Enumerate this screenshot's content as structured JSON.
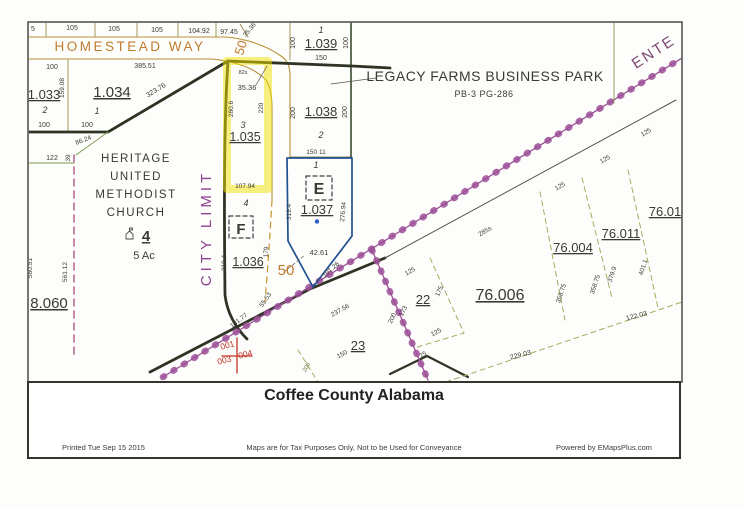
{
  "colors": {
    "ink": "#3a3933",
    "orange": "#c07b2e",
    "citypurple": "#8e3f8f",
    "mauve": "#7c4a74",
    "red": "#c23327",
    "dimgreen": "#6a7a42",
    "road_purple": "#9b4f96",
    "boundary_dark": "#2e3424",
    "highlight_yellow": "#f0e000",
    "parcel_blue": "#20508f",
    "road_tan": "#b98f33"
  },
  "footer": {
    "title": "Coffee County Alabama",
    "printed": "Printed Tue Sep 15 2015",
    "disclaimer": "Maps are for Tax Purposes Only, Not to be Used for Conveyance",
    "powered": "Powered by EMapsPlus.com"
  },
  "map": {
    "labels": [
      {
        "n": "lot-width-5",
        "t": "5",
        "x": 33,
        "y": 31,
        "s": 7
      },
      {
        "n": "lot-width-105-a",
        "t": "105",
        "x": 72,
        "y": 30,
        "s": 7
      },
      {
        "n": "lot-width-105-b",
        "t": "105",
        "x": 114,
        "y": 31,
        "s": 7
      },
      {
        "n": "lot-width-105-c",
        "t": "105",
        "x": 157,
        "y": 32,
        "s": 7
      },
      {
        "n": "lot-width-104-92",
        "t": "104.92",
        "x": 199,
        "y": 33,
        "s": 7
      },
      {
        "n": "lot-width-97-45",
        "t": "97.45",
        "x": 229,
        "y": 34,
        "s": 7
      },
      {
        "n": "dim-35-36-corner",
        "t": "35.36",
        "x": 251,
        "y": 31,
        "r": -50,
        "s": 6.5
      },
      {
        "n": "street-homestead-way",
        "t": "HOMESTEAD WAY",
        "x": 130,
        "y": 51,
        "s": 13.5,
        "c": "orange",
        "ls": 2.5
      },
      {
        "n": "dim-100-a",
        "t": "100",
        "x": 52,
        "y": 69,
        "s": 7
      },
      {
        "n": "dim-159-08",
        "t": "159.08",
        "x": 64,
        "y": 88,
        "r": -90,
        "s": 6.5
      },
      {
        "n": "dim-385-51",
        "t": "385.51",
        "x": 145,
        "y": 68,
        "s": 7
      },
      {
        "n": "parcel-1-033",
        "t": "1.033",
        "x": 44,
        "y": 99,
        "s": 13,
        "u": 1
      },
      {
        "n": "lot-2-1033",
        "t": "2",
        "x": 45,
        "y": 113,
        "s": 9,
        "i": 1
      },
      {
        "n": "dim-100-b",
        "t": "100",
        "x": 44,
        "y": 127,
        "s": 7
      },
      {
        "n": "parcel-1-034",
        "t": "1.034",
        "x": 112,
        "y": 97,
        "s": 15,
        "u": 1
      },
      {
        "n": "lot-1-1034",
        "t": "1",
        "x": 97,
        "y": 114,
        "s": 9,
        "i": 1
      },
      {
        "n": "dim-100-c",
        "t": "100",
        "x": 87,
        "y": 127,
        "s": 7
      },
      {
        "n": "dim-323-76",
        "t": "323.76",
        "x": 157,
        "y": 92,
        "r": -31,
        "s": 7
      },
      {
        "n": "road-50-top",
        "t": "50",
        "x": 245,
        "y": 49,
        "r": -72,
        "s": 13,
        "c": "orange"
      },
      {
        "n": "dim-86-24",
        "t": "86.24",
        "x": 84,
        "y": 142,
        "r": -21,
        "s": 6.5
      },
      {
        "n": "dim-39",
        "t": "39",
        "x": 70,
        "y": 158,
        "r": -90,
        "s": 6.5
      },
      {
        "n": "dim-122",
        "t": "122",
        "x": 52,
        "y": 160,
        "s": 7
      },
      {
        "n": "church-name-line1",
        "t": "HERITAGE",
        "x": 136,
        "y": 162,
        "s": 11.5,
        "ls": 1.5
      },
      {
        "n": "church-name-line2",
        "t": "UNITED",
        "x": 136,
        "y": 180,
        "s": 11.5,
        "ls": 1.5
      },
      {
        "n": "church-name-line3",
        "t": "METHODIST",
        "x": 136,
        "y": 198,
        "s": 11.5,
        "ls": 1.5
      },
      {
        "n": "church-name-line4",
        "t": "CHURCH",
        "x": 136,
        "y": 216,
        "s": 11.5,
        "ls": 1.5
      },
      {
        "n": "parcel-4-church",
        "t": "4",
        "x": 146,
        "y": 241,
        "s": 15,
        "w": "bold",
        "u": 1
      },
      {
        "n": "church-acreage",
        "t": "5 Ac",
        "x": 144,
        "y": 259,
        "s": 11
      },
      {
        "n": "dim-560-51",
        "t": "560.51",
        "x": 32,
        "y": 268,
        "r": -90,
        "s": 6.5
      },
      {
        "n": "dim-561-12",
        "t": "561.12",
        "x": 67,
        "y": 272,
        "r": -90,
        "s": 6.5
      },
      {
        "n": "parcel-8-060",
        "t": "8.060",
        "x": 49,
        "y": 308,
        "s": 15,
        "u": 1
      },
      {
        "n": "city-limit-label",
        "t": "CITY LIMIT",
        "x": 211,
        "y": 228,
        "r": -90,
        "s": 15,
        "c": "citypurple",
        "ls": 4
      },
      {
        "n": "dim-82s",
        "t": "82s",
        "x": 243,
        "y": 74,
        "s": 5.5
      },
      {
        "n": "dim-35-36",
        "t": "35.36",
        "x": 247,
        "y": 90,
        "s": 7.5
      },
      {
        "n": "dim-280-6",
        "t": "280.6",
        "x": 233,
        "y": 109,
        "r": -90,
        "s": 6.5
      },
      {
        "n": "dim-220",
        "t": "220",
        "x": 263,
        "y": 108,
        "r": -90,
        "s": 6.5
      },
      {
        "n": "lot-3-1035",
        "t": "3",
        "x": 243,
        "y": 128,
        "s": 9,
        "i": 1
      },
      {
        "n": "parcel-1-035",
        "t": "1.035",
        "x": 245,
        "y": 141,
        "s": 12.5,
        "u": 1
      },
      {
        "n": "dim-107-94",
        "t": "107.94",
        "x": 245,
        "y": 188,
        "s": 6.5
      },
      {
        "n": "lot-4-1036",
        "t": "4",
        "x": 246,
        "y": 206,
        "s": 9,
        "i": 1
      },
      {
        "n": "flood-zone-f",
        "t": "F",
        "x": 241,
        "y": 234,
        "s": 15,
        "w": "bold"
      },
      {
        "n": "dim-319-4-f",
        "t": "319.4",
        "x": 226,
        "y": 263,
        "r": -90,
        "s": 6.5
      },
      {
        "n": "parcel-1-036",
        "t": "1.036",
        "x": 248,
        "y": 266,
        "s": 12.5,
        "u": 1
      },
      {
        "n": "dim-179",
        "t": "179",
        "x": 268,
        "y": 252,
        "r": -87,
        "s": 6.5
      },
      {
        "n": "road-50-mid",
        "t": "50",
        "x": 286,
        "y": 275,
        "s": 15,
        "c": "orange"
      },
      {
        "n": "dim-55-53",
        "t": "55.53",
        "x": 267,
        "y": 301,
        "r": -55,
        "s": 6.5
      },
      {
        "n": "dim-131-77",
        "t": "131.77",
        "x": 240,
        "y": 322,
        "r": -38,
        "s": 6.5
      },
      {
        "n": "lot-1-1039",
        "t": "1",
        "x": 321,
        "y": 33,
        "s": 9,
        "i": 1
      },
      {
        "n": "parcel-1-039",
        "t": "1.039",
        "x": 321,
        "y": 48,
        "s": 13,
        "u": 1
      },
      {
        "n": "dim-100-1039-w",
        "t": "100",
        "x": 295,
        "y": 43,
        "r": -90,
        "s": 7
      },
      {
        "n": "dim-100-1039-e",
        "t": "100",
        "x": 348,
        "y": 43,
        "r": -90,
        "s": 7
      },
      {
        "n": "dim-150-1039",
        "t": "150",
        "x": 321,
        "y": 60,
        "s": 7
      },
      {
        "n": "dim-200-1038-w",
        "t": "200",
        "x": 295,
        "y": 113,
        "r": -90,
        "s": 7
      },
      {
        "n": "dim-200-1038-e",
        "t": "200",
        "x": 347,
        "y": 112,
        "r": -90,
        "s": 7
      },
      {
        "n": "parcel-1-038",
        "t": "1.038",
        "x": 321,
        "y": 116,
        "s": 13,
        "u": 1
      },
      {
        "n": "lot-2-1038",
        "t": "2",
        "x": 321,
        "y": 138,
        "s": 9,
        "i": 1
      },
      {
        "n": "dim-150-11",
        "t": "150 11",
        "x": 316,
        "y": 154,
        "s": 6.5
      },
      {
        "n": "lot-1-1037",
        "t": "1",
        "x": 316,
        "y": 168,
        "s": 9,
        "i": 1
      },
      {
        "n": "flood-zone-e",
        "t": "E",
        "x": 319,
        "y": 194,
        "s": 16,
        "w": "bold"
      },
      {
        "n": "parcel-1-037",
        "t": "1.037",
        "x": 317,
        "y": 214,
        "s": 13,
        "u": 1
      },
      {
        "n": "dim-319-4-e",
        "t": "319.4",
        "x": 291,
        "y": 212,
        "r": -90,
        "s": 6.5
      },
      {
        "n": "dim-276-94",
        "t": "276.94",
        "x": 345,
        "y": 212,
        "r": -85,
        "s": 6.5
      },
      {
        "n": "dim-42-61",
        "t": "42.61",
        "x": 319,
        "y": 255,
        "s": 7.5
      },
      {
        "n": "dim-101-26",
        "t": "101.26",
        "x": 332,
        "y": 271,
        "r": -40,
        "s": 6.5
      },
      {
        "n": "subdivision-name",
        "t": "LEGACY FARMS BUSINESS PARK",
        "x": 485,
        "y": 81,
        "s": 14,
        "ls": 0.5
      },
      {
        "n": "subdivision-plat",
        "t": "PB-3  PG-286",
        "x": 484,
        "y": 97,
        "s": 9,
        "ls": 0.5
      },
      {
        "n": "street-enterprise",
        "t": "ENTE",
        "x": 656,
        "y": 56,
        "r": -33,
        "s": 15,
        "c": "mauve",
        "ls": 2
      },
      {
        "n": "dim-237-56",
        "t": "237.56",
        "x": 341,
        "y": 312,
        "r": -29,
        "s": 6.5
      },
      {
        "n": "dim-150-23",
        "t": "150",
        "x": 343,
        "y": 356,
        "r": -27,
        "s": 6.5
      },
      {
        "n": "dim-206",
        "t": "206",
        "x": 308,
        "y": 368,
        "r": -62,
        "s": 6,
        "c": "dimgreen"
      },
      {
        "n": "marker-001",
        "t": "001",
        "x": 228,
        "y": 348,
        "r": -14,
        "s": 8.5,
        "c": "red"
      },
      {
        "n": "marker-003",
        "t": "003",
        "x": 225,
        "y": 363,
        "r": -14,
        "s": 8.5,
        "c": "red"
      },
      {
        "n": "marker-004",
        "t": "004",
        "x": 246,
        "y": 357,
        "r": -14,
        "s": 8.5,
        "c": "red"
      },
      {
        "n": "dim-125-22n",
        "t": "125",
        "x": 411,
        "y": 273,
        "r": -31,
        "s": 6.5
      },
      {
        "n": "parcel-22",
        "t": "22",
        "x": 423,
        "y": 304,
        "s": 13,
        "u": 1
      },
      {
        "n": "dim-175",
        "t": "175",
        "x": 441,
        "y": 292,
        "r": -65,
        "s": 6.5
      },
      {
        "n": "dim-173",
        "t": "173",
        "x": 405,
        "y": 312,
        "r": -64,
        "s": 6.5
      },
      {
        "n": "dim-200-roadb",
        "t": "200",
        "x": 394,
        "y": 319,
        "r": -64,
        "s": 6.5
      },
      {
        "n": "dim-125-22s",
        "t": "125",
        "x": 437,
        "y": 334,
        "r": -27,
        "s": 6.5
      },
      {
        "n": "dim-25",
        "t": "25",
        "x": 424,
        "y": 356,
        "r": -30,
        "s": 6
      },
      {
        "n": "parcel-23",
        "t": "23",
        "x": 358,
        "y": 350,
        "s": 13,
        "u": 1
      },
      {
        "n": "dim-229-03",
        "t": "229.03",
        "x": 521,
        "y": 357,
        "r": -14,
        "s": 7
      },
      {
        "n": "parcel-76-006",
        "t": "76.006",
        "x": 500,
        "y": 300,
        "s": 16,
        "u": 1
      },
      {
        "n": "dim-285s",
        "t": "285s",
        "x": 486,
        "y": 233,
        "r": -30,
        "s": 6.5
      },
      {
        "n": "dim-125-a",
        "t": "125",
        "x": 561,
        "y": 188,
        "r": -31,
        "s": 6.5
      },
      {
        "n": "dim-125-b",
        "t": "125",
        "x": 606,
        "y": 161,
        "r": -31,
        "s": 6.5
      },
      {
        "n": "dim-125-c",
        "t": "125",
        "x": 647,
        "y": 134,
        "r": -31,
        "s": 6.5
      },
      {
        "n": "parcel-76-004",
        "t": "76.004",
        "x": 573,
        "y": 252,
        "s": 13,
        "u": 1
      },
      {
        "n": "parcel-76-011",
        "t": "76.011",
        "x": 621,
        "y": 238,
        "s": 13,
        "u": 1
      },
      {
        "n": "parcel-76-01",
        "t": "76.01",
        "x": 665,
        "y": 216,
        "s": 13,
        "u": 1
      },
      {
        "n": "dim-358-75-a",
        "t": "358.75",
        "x": 563,
        "y": 294,
        "r": -72,
        "s": 6.5
      },
      {
        "n": "dim-358-75-b",
        "t": "358.75",
        "x": 597,
        "y": 285,
        "r": -72,
        "s": 6.5
      },
      {
        "n": "dim-379-9",
        "t": "379.9",
        "x": 614,
        "y": 275,
        "r": -72,
        "s": 6.5
      },
      {
        "n": "dim-401-1",
        "t": "401.1",
        "x": 645,
        "y": 268,
        "r": -72,
        "s": 6.5
      },
      {
        "n": "dim-122-03",
        "t": "122.03",
        "x": 637,
        "y": 318,
        "r": -14,
        "s": 7
      }
    ]
  }
}
